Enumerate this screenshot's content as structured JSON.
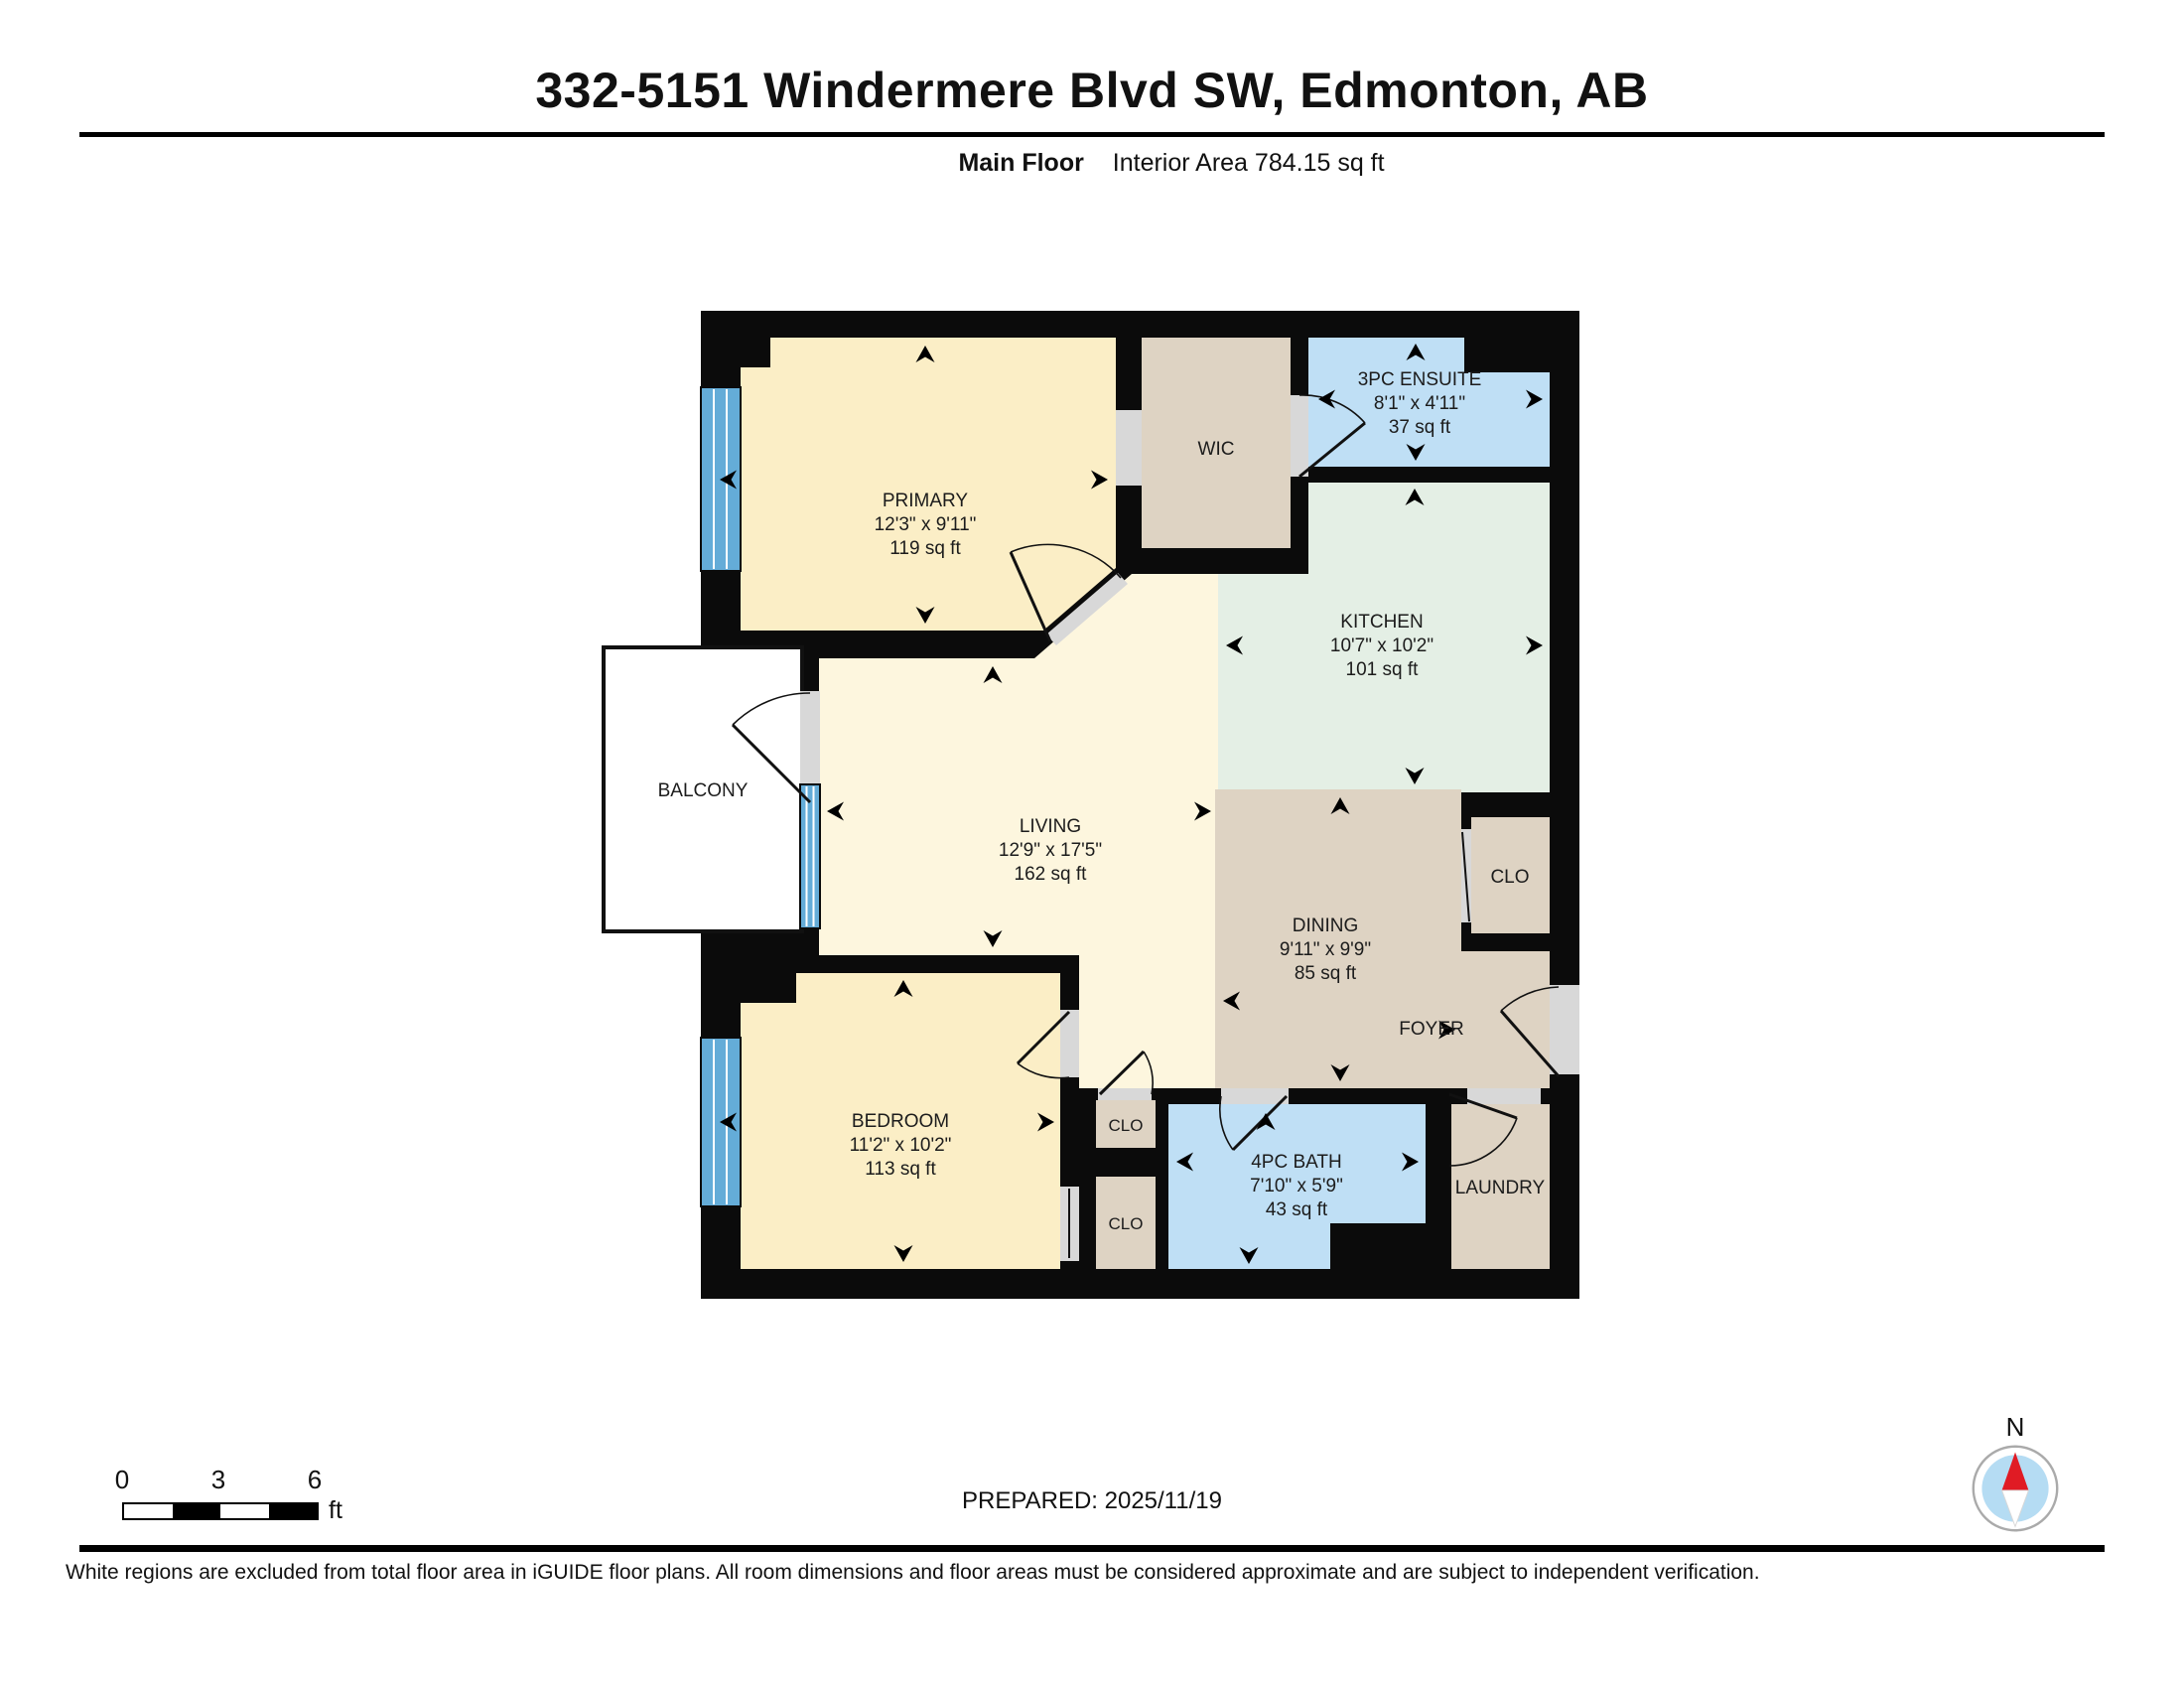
{
  "header": {
    "title": "332-5151 Windermere Blvd SW, Edmonton, AB",
    "floor_label": "Main Floor",
    "area_label": "Interior Area 784.15 sq ft"
  },
  "rooms": {
    "primary": {
      "name": "PRIMARY",
      "dims": "12'3\" x 9'11\"",
      "area": "119 sq ft"
    },
    "wic": {
      "name": "WIC"
    },
    "ensuite": {
      "name": "3PC ENSUITE",
      "dims": "8'1\" x 4'11\"",
      "area": "37 sq ft"
    },
    "kitchen": {
      "name": "KITCHEN",
      "dims": "10'7\" x 10'2\"",
      "area": "101 sq ft"
    },
    "living": {
      "name": "LIVING",
      "dims": "12'9\" x 17'5\"",
      "area": "162 sq ft"
    },
    "balcony": {
      "name": "BALCONY"
    },
    "dining": {
      "name": "DINING",
      "dims": "9'11\" x 9'9\"",
      "area": "85 sq ft"
    },
    "dining_closet": {
      "name": "CLO"
    },
    "foyer": {
      "name": "FOYER"
    },
    "bedroom": {
      "name": "BEDROOM",
      "dims": "11'2\" x 10'2\"",
      "area": "113 sq ft"
    },
    "closet_upper": {
      "name": "CLO"
    },
    "closet_lower": {
      "name": "CLO"
    },
    "bath": {
      "name": "4PC BATH",
      "dims": "7'10\" x 5'9\"",
      "area": "43 sq ft"
    },
    "laundry": {
      "name": "LAUNDRY"
    }
  },
  "scale_bar": {
    "tick0": "0",
    "tick1": "3",
    "tick2": "6",
    "unit": "ft"
  },
  "prepared_label": "PREPARED: 2025/11/19",
  "compass": {
    "north_label": "N"
  },
  "disclaimer": "White regions are excluded from total floor area in iGUIDE floor plans. All room dimensions and floor areas must be considered approximate and are subject to independent verification.",
  "colors": {
    "wall": "#0b0b0b",
    "room_cream": "#fbeec6",
    "room_cream_light": "#fdf6de",
    "room_tan": "#ded3c3",
    "room_blue": "#bfdff5",
    "room_green": "#e4efe5",
    "window_blue": "#64acd8",
    "threshold_gray": "#d8d8d8",
    "compass_red": "#e01b24",
    "compass_blue": "#b5dcf3"
  }
}
